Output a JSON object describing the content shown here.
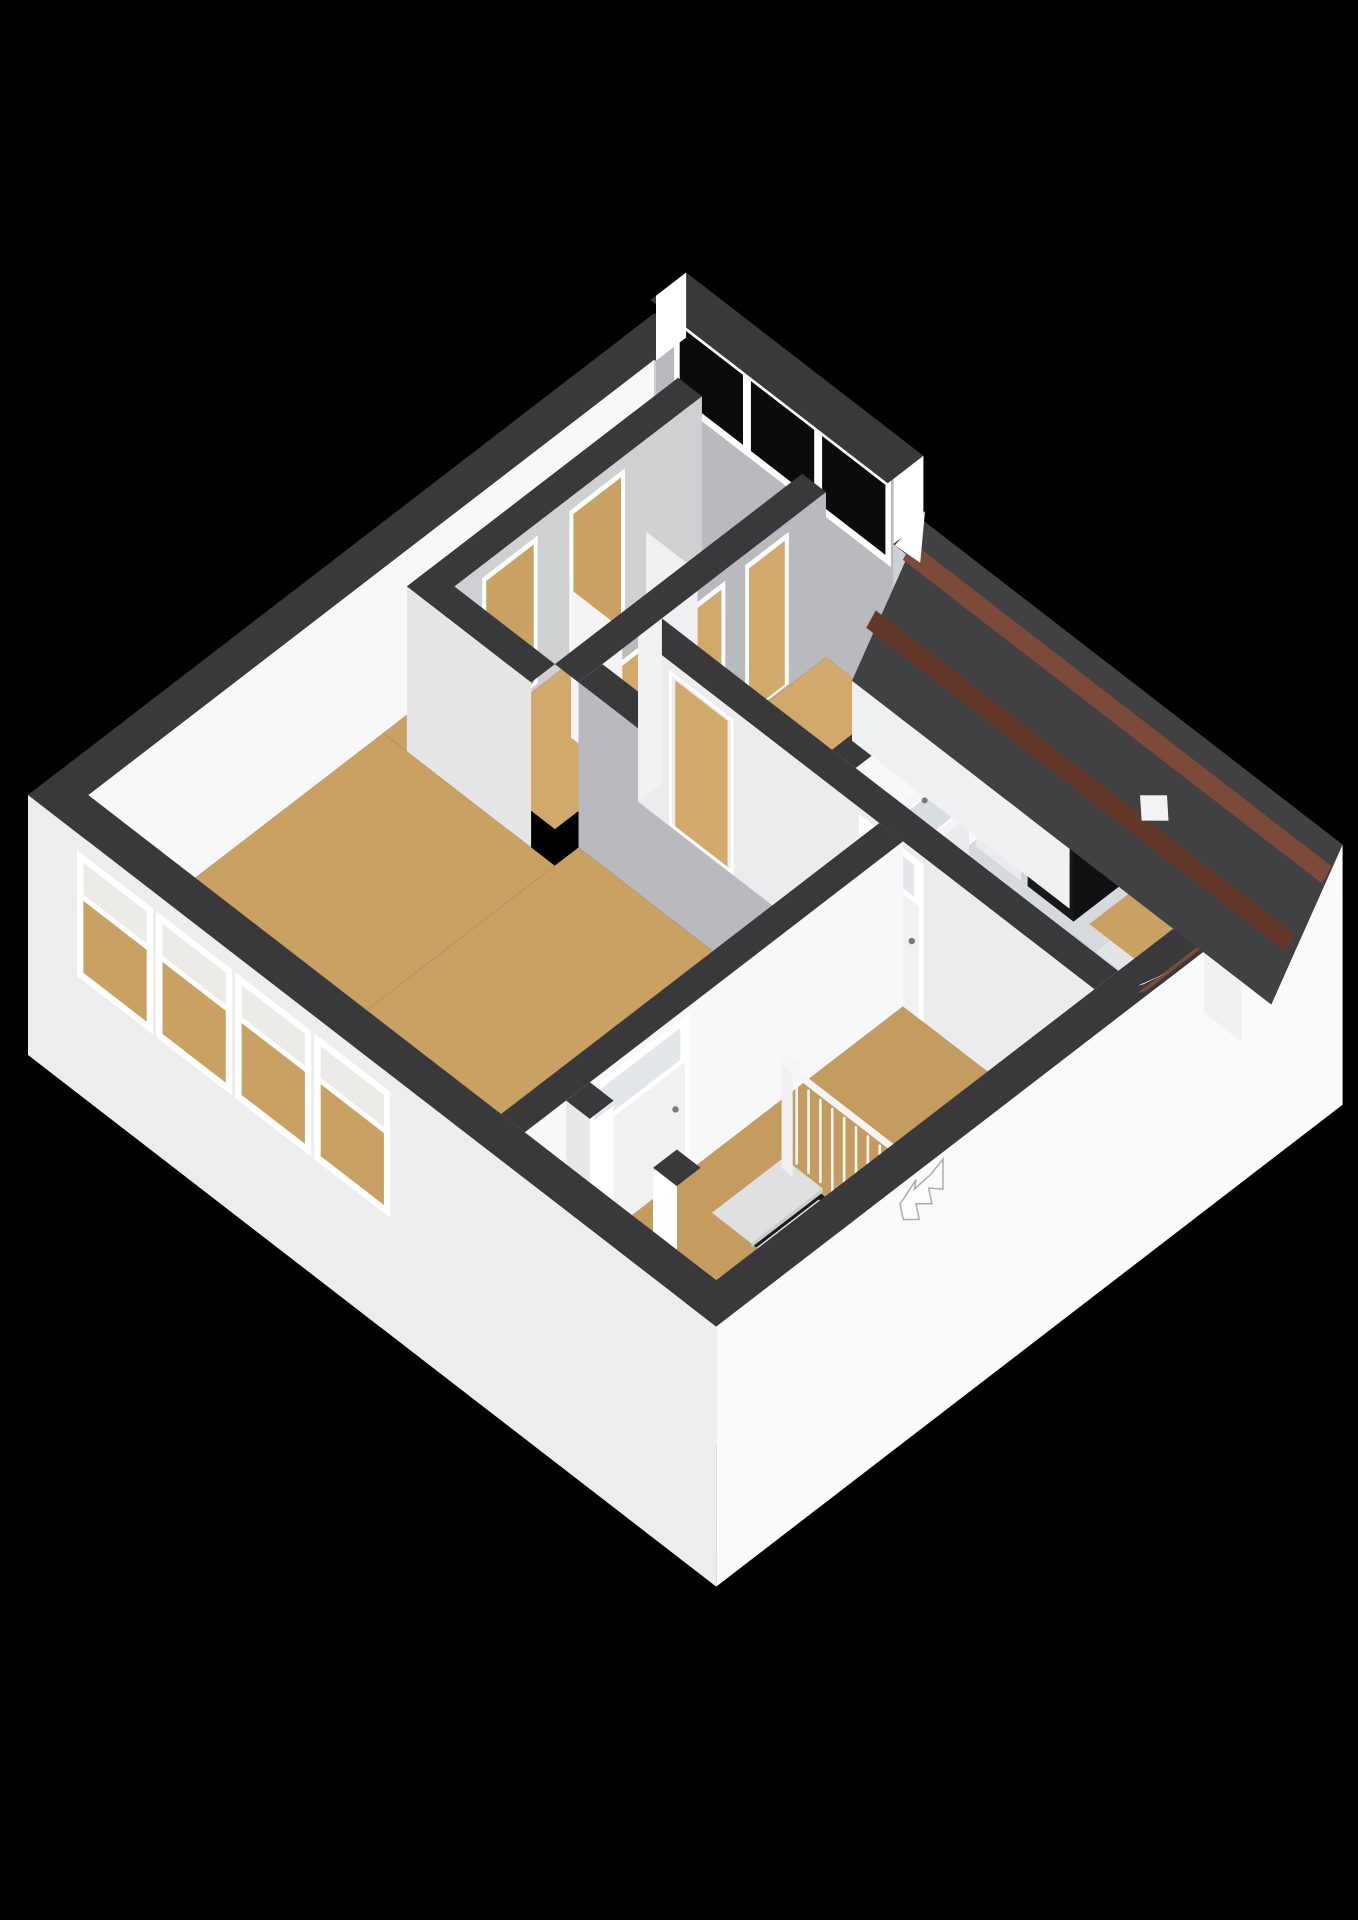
{
  "canvas": {
    "width": 1358,
    "height": 1920,
    "background": "#000000"
  },
  "scene": {
    "kind": "isometric-3d-floorplan",
    "floor_shown": "upper-floor",
    "rooms": [
      "bedroom-large",
      "bedroom-back",
      "closet-room",
      "landing-hallway",
      "bathroom",
      "laundry-nook",
      "storage-under-roof"
    ],
    "fixtures": [
      "washing-machine",
      "tall-cabinet",
      "sink-vanity",
      "shower",
      "staircase",
      "stair-railing",
      "dormer-windows",
      "facade-windows"
    ]
  },
  "colors": {
    "background": "#000000",
    "floorTan": "#c9a163",
    "floorTanLight": "#d0a96b",
    "floorHall": "#c49c5f",
    "bathFloor": "#d6dadd",
    "showerFloor": "#e9e7e1",
    "wallTop": "#39393b",
    "wallLit": "#f8f8fa",
    "wallMid": "#ececee",
    "wallShade": "#b9babd",
    "wallShadeLight": "#cfd0d2",
    "extLeft": "#ededef",
    "extFront": "#fafafa",
    "glassDark": "#0b0b0d",
    "glassPale": "#e4e7ea",
    "trim": "#ffffff",
    "door": "#f1f1f3",
    "handle": "#77787a",
    "roof": "#414144",
    "roofDark": "#39393c",
    "fascia": "#7b4a38",
    "fasciaDark": "#643828",
    "washerBody": "#ebebed",
    "washerTop": "#dddee0",
    "washerSide": "#d2d2d4",
    "washerRing": "#27272b",
    "washerDrum": "#55565a",
    "cabinetTop": "#232327",
    "cabinetFront": "#18181b",
    "cabinetSide": "#111114",
    "darkBoxTop": "#2c2927",
    "darkBoxSide": "#201e1c",
    "vanityTop": "#f4f4f6",
    "vanityFront": "#eaeaec",
    "vanitySide": "#e0e0e2",
    "basin": "#d8dde2",
    "pit": "#1b1b1d",
    "tread": "#e6e6e8",
    "treadAlt": "#dcdcde",
    "riser": "#c9c9cb",
    "rail": "#f5f5f7",
    "landing": "#e0e0e2",
    "ceilSlope": "#eef0f2"
  }
}
